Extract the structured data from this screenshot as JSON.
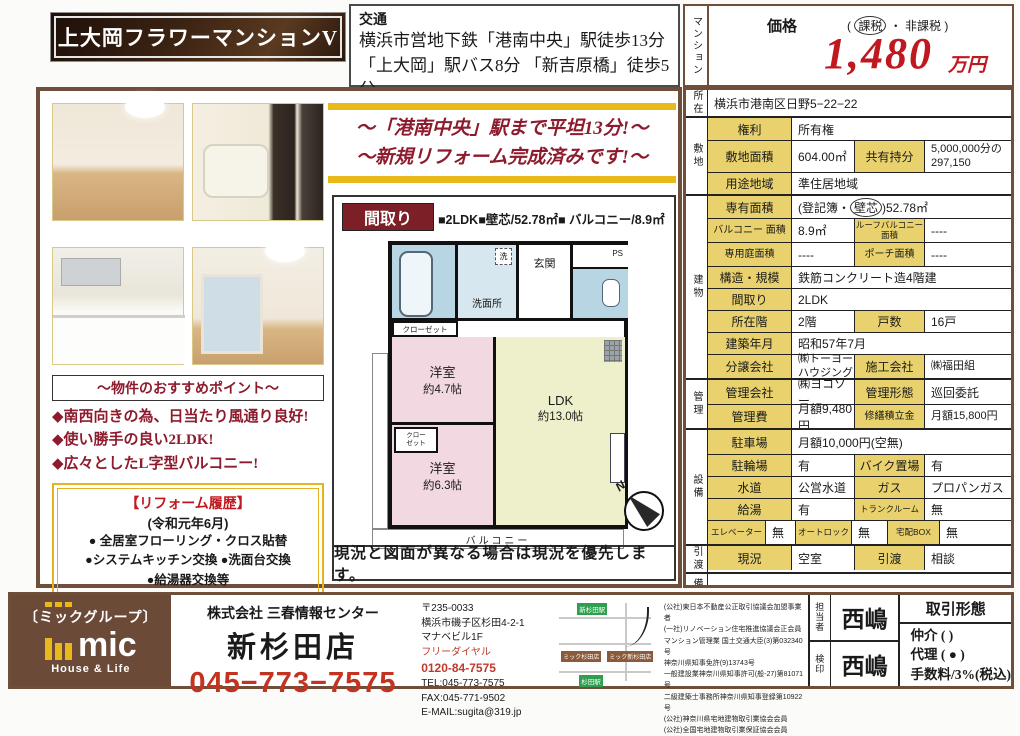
{
  "header": {
    "title": "上大岡フラワーマンションV",
    "transport_label": "交通",
    "transport_line1": "横浜市営地下鉄「港南中央」駅徒歩13分",
    "transport_line2": "「上大岡」駅バス8分 「新吉原橋」徒歩5分",
    "property_type_vertical": "マンション",
    "price_label": "価格",
    "tax_open": "( ",
    "tax_circled": "課税",
    "tax_rest": " ・ 非課税 )",
    "price_value": "1,480",
    "price_unit": "万円"
  },
  "banner": {
    "line1": "〜「港南中央」駅まで平坦13分!〜",
    "line2": "〜新規リフォーム完成済みです!〜"
  },
  "points": {
    "header": "〜物件のおすすめポイント〜",
    "items": [
      "◆南西向きの為、日当たり風通り良好!",
      "◆使い勝手の良い2LDK!",
      "◆広々としたL字型バルコニー!"
    ],
    "reform_title": "【リフォーム履歴】",
    "reform_date": "(令和元年6月)",
    "reform_items": [
      "● 全居室フローリング・クロス貼替",
      "●システムキッチン交換 ●洗面台交換",
      "●給湯器交換等"
    ]
  },
  "floorplan": {
    "header": "間取り",
    "spec": "■2LDK■壁芯/52.78㎡■ バルコニー/8.9㎡",
    "bath_label": "浴室",
    "sen_label": "洗",
    "senmenjo_label": "洗面所",
    "genkan_label": "玄関",
    "ps_label": "PS",
    "closet1_label": "クローゼット",
    "closet2_line1": "クロー",
    "closet2_line2": "ゼット",
    "room1_name": "洋室",
    "room1_size": "約4.7帖",
    "room2_name": "洋室",
    "room2_size": "約6.3帖",
    "ldk_name": "LDK",
    "ldk_size": "約13.0帖",
    "balcony_label": "バルコニー",
    "north_label": "N",
    "caption": "現況と図面が異なる場合は現況を優先します。"
  },
  "table": {
    "location_label": "所在",
    "location_value": "横浜市港南区日野5−22−22",
    "land_label": "敷地",
    "rights_label": "権利",
    "rights_value": "所有権",
    "land_area_label": "敷地面積",
    "land_area_value": "604.00㎡",
    "share_label": "共有持分",
    "share_value": "5,000,000分の 297,150",
    "zoning_label": "用途地域",
    "zoning_value": "準住居地域",
    "building_label": "建物",
    "exclusive_label": "専有面積",
    "exclusive_prefix": "(登記簿・",
    "exclusive_circled": "壁芯",
    "exclusive_suffix": ")52.78㎡",
    "balcony_label": "バルコニー 面積",
    "balcony_value": "8.9㎡",
    "roof_balcony_label": "ルーフバルコニー 面積",
    "roof_balcony_value": "----",
    "garden_label": "専用庭面積",
    "garden_value": "----",
    "porch_label": "ポーチ面積",
    "porch_value": "----",
    "structure_label": "構造・規模",
    "structure_value": "鉄筋コンクリート造4階建",
    "layout_label": "間取り",
    "layout_value": "2LDK",
    "floor_label": "所在階",
    "floor_value": "2階",
    "units_label": "戸数",
    "units_value": "16戸",
    "built_label": "建築年月",
    "built_value": "昭和57年7月",
    "developer_label": "分譲会社",
    "developer_value": "㈱トーヨーハウジング",
    "builder_label": "施工会社",
    "builder_value": "㈱福田組",
    "mgmt_label": "管理",
    "mgmt_co_label": "管理会社",
    "mgmt_co_value": "㈱ヨコソー",
    "mgmt_type_label": "管理形態",
    "mgmt_type_value": "巡回委託",
    "mgmt_fee_label": "管理費",
    "mgmt_fee_value": "月額9,480円",
    "repair_label": "修繕積立金",
    "repair_value": "月額15,800円",
    "equip_label": "設備",
    "parking_label": "駐車場",
    "parking_value": "月額10,000円(空無)",
    "bicycle_label": "駐輪場",
    "bicycle_value": "有",
    "bike_label": "バイク置場",
    "bike_value": "有",
    "water_label": "水道",
    "water_value": "公営水道",
    "gas_label": "ガス",
    "gas_value": "プロパンガス",
    "hotwater_label": "給湯",
    "hotwater_value": "有",
    "trunk_label": "トランクルーム",
    "trunk_value": "無",
    "elevator_label": "エレベーター",
    "elevator_value": "無",
    "autolock_label": "オートロック",
    "autolock_value": "無",
    "deliverybox_label": "宅配BOX",
    "deliverybox_value": "無",
    "handover_label": "引渡",
    "status_label": "現況",
    "status_value": "空室",
    "delivery_label": "引渡",
    "delivery_value": "相談",
    "remarks_label": "備考",
    "remarks_value": ""
  },
  "footer": {
    "group_name": "〔ミックグループ〕",
    "logo_text": "mic",
    "logo_sub": "House & Life",
    "company": "株式会社 三春情報センター",
    "branch": "新杉田店",
    "phone": "045−773−7575",
    "postal": "〒235-0033",
    "address1": "横浜市磯子区杉田4-2-1",
    "address2": "マナベビル1F",
    "free_dial_label": "フリーダイヤル",
    "free_dial": "0120-84-7575",
    "tel": "TEL:045-773-7575",
    "fax": "FAX:045-771-9502",
    "email": "E-MAIL:sugita@319.jp",
    "map": {
      "station1": "新杉田駅",
      "station2": "杉田駅",
      "store1": "ミック新杉田店",
      "store2": "ミック杉田店"
    },
    "licenses": [
      "(公社)東日本不動産公正取引協議会加盟事業者",
      "(一社)リノベーション住宅推進協議会正会員",
      "マンション管理業 国土交通大臣(3)第032340号",
      "神奈川県知事免許(9)13743号",
      "一般建設業神奈川県知事許可(般-27)第81071号",
      "二級建築士事務所神奈川県知事登録第10922号",
      "(公社)神奈川県宅地建物取引業協会会員",
      "(公社)全国宅地建物取引業保証協会会員"
    ],
    "staff_label": "担当者",
    "staff_name": "西嶋",
    "seal_label": "検印",
    "seal_name": "西嶋",
    "deal_header": "取引形態",
    "deal_line1": "仲介 (       )",
    "deal_line2": "代理 ( ● )",
    "deal_line3": "手数料/3%(税込)"
  }
}
